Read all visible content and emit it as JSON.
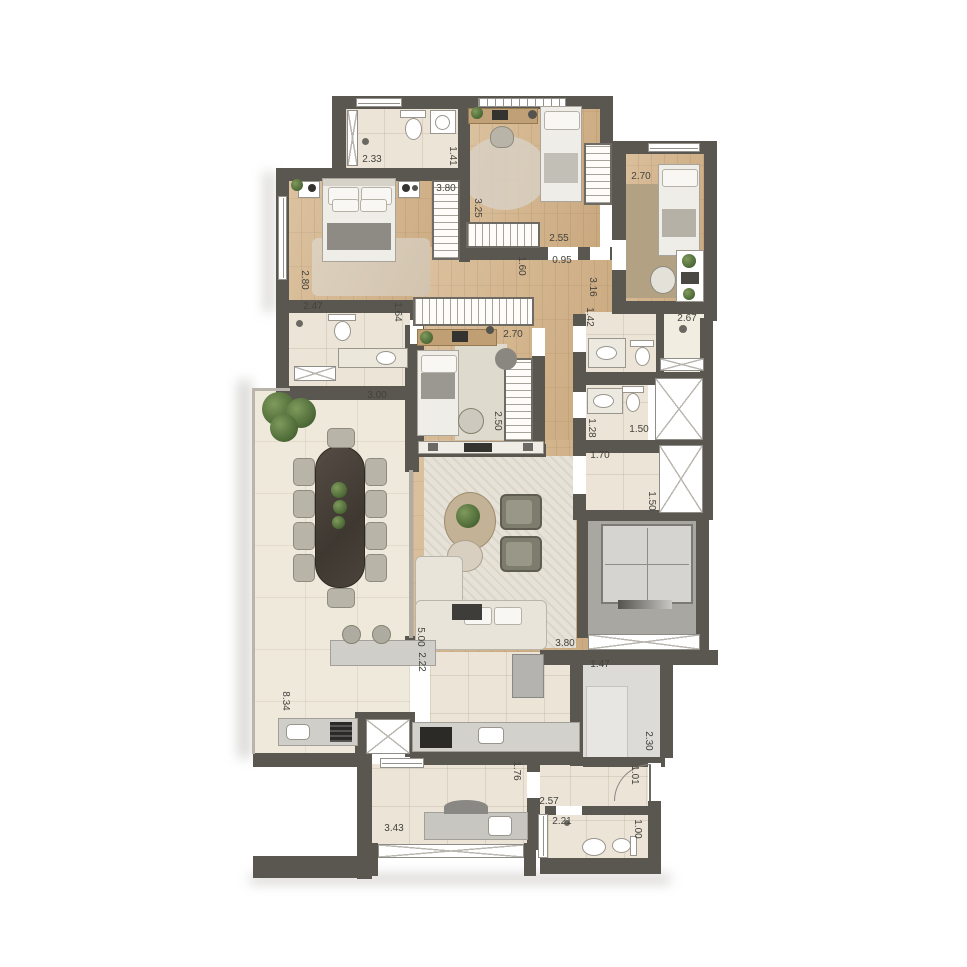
{
  "plan_type": "apartment-floor-plan",
  "palette": {
    "wall": "#5a5751",
    "wood_floor": "#d3b58e",
    "tile_floor": "#ece5d7",
    "elevator_hall": "#a9a7a2",
    "entry_room": "#dcdbd7",
    "rug": "#e7e2d8",
    "dining_table": "#4a433b",
    "plant_green": "#4f6b38",
    "label_text": "#44423d"
  },
  "dims": {
    "bath1_w": "2.33",
    "bath1_d": "1.41",
    "closet1": "3.80",
    "bed2_d": "3.25",
    "hall_w1": "2.55",
    "hall_w2": "0.95",
    "hall_d1": "1.60",
    "hall_d2": "3.16",
    "bed3_w": "2.70",
    "master_d": "2.80",
    "bath2_w": "2.47",
    "bath2_d": "1.64",
    "bath3_d": "1.42",
    "bath3_w": "2.67",
    "bed4_w": "2.70",
    "bed4_d": "2.50",
    "terrace_w": "3.00",
    "terrace_d": "8.34",
    "bath4_d": "1.28",
    "bath4_w": "1.50",
    "foyer_w": "1.70",
    "shaft_d": "1.50",
    "living_d": "5.00",
    "living_w": "3.80",
    "kitchen_d": "2.22",
    "hall2_w": "1.47",
    "hall2_d": "2.30",
    "pass_w": "1.01",
    "pass_d": "1.76",
    "serv_w": "2.57",
    "wc_w": "2.21",
    "wc_d": "1.00",
    "laundry_w": "3.43"
  }
}
